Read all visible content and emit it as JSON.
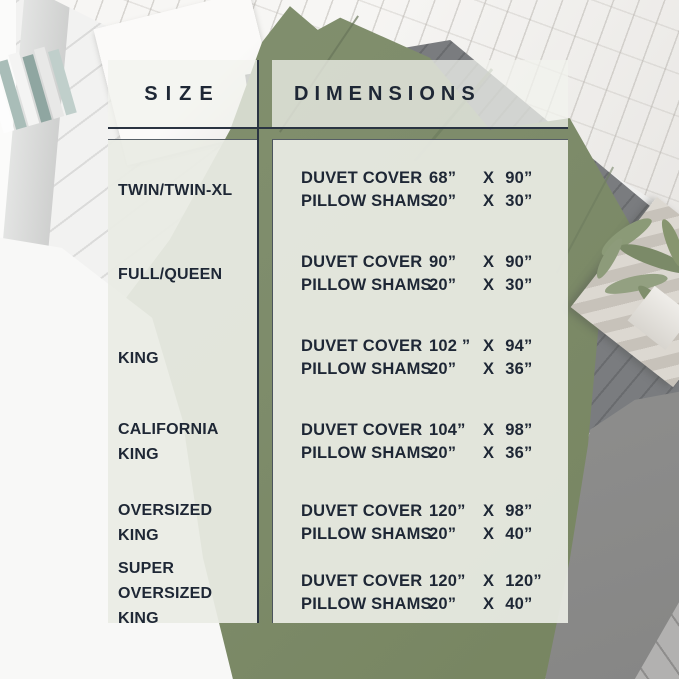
{
  "title": "Duvet cover and pillow sham size chart",
  "colors": {
    "sage_green": "#7e8c6b",
    "navy_text": "#1e2735",
    "panel_light": "#e9ebe3",
    "rule_dark": "#2a3442"
  },
  "chart_data": {
    "type": "table",
    "columns": [
      "SIZE",
      "DIMENSIONS"
    ],
    "separator": "X",
    "rows": [
      {
        "size_lines": [
          "TWIN/TWIN-XL"
        ],
        "items": [
          {
            "name": "DUVET COVER",
            "width": "68”",
            "height": "90”"
          },
          {
            "name": "PILLOW SHAMS",
            "width": "20”",
            "height": "30”"
          }
        ]
      },
      {
        "size_lines": [
          "FULL/QUEEN"
        ],
        "items": [
          {
            "name": "DUVET COVER",
            "width": "90”",
            "height": "90”"
          },
          {
            "name": "PILLOW SHAMS",
            "width": "20”",
            "height": "30”"
          }
        ]
      },
      {
        "size_lines": [
          "KING"
        ],
        "items": [
          {
            "name": "DUVET COVER",
            "width": "102 ”",
            "height": "94”"
          },
          {
            "name": "PILLOW SHAMS",
            "width": "20”",
            "height": "36”"
          }
        ]
      },
      {
        "size_lines": [
          "CALIFORNIA",
          "KING"
        ],
        "items": [
          {
            "name": "DUVET COVER",
            "width": "104”",
            "height": "98”"
          },
          {
            "name": "PILLOW SHAMS",
            "width": "20”",
            "height": "36”"
          }
        ]
      },
      {
        "size_lines": [
          "OVERSIZED KING"
        ],
        "items": [
          {
            "name": "DUVET COVER",
            "width": "120”",
            "height": "98”"
          },
          {
            "name": "PILLOW SHAMS",
            "width": "20”",
            "height": "40”"
          }
        ]
      },
      {
        "size_lines": [
          "SUPER",
          "OVERSIZED KING"
        ],
        "items": [
          {
            "name": "DUVET COVER",
            "width": "120”",
            "height": "120”"
          },
          {
            "name": "PILLOW SHAMS",
            "width": "20”",
            "height": "40”"
          }
        ]
      }
    ]
  }
}
